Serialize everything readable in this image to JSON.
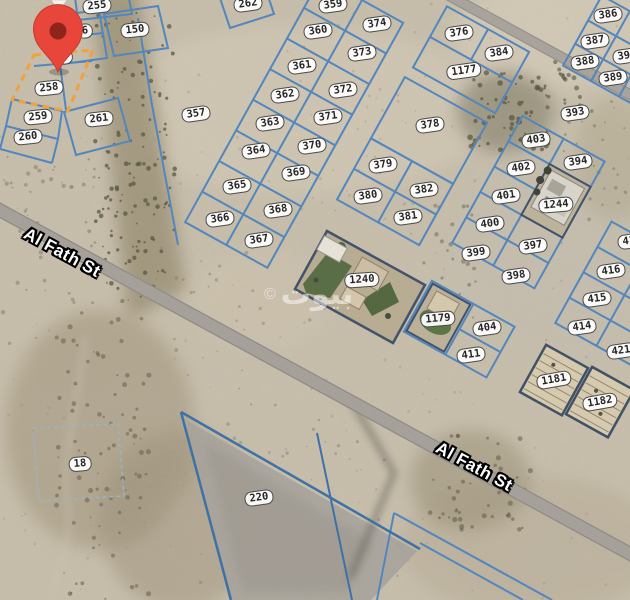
{
  "app": {
    "type": "satellite-parcel-map",
    "description": "Satellite map with land parcel boundaries and plot numbers"
  },
  "watermark": {
    "copyright": "©",
    "brand": "بيوت"
  },
  "streets": [
    {
      "name": "Al Fath St",
      "x": 62,
      "y": 253
    },
    {
      "name": "Al Fath St",
      "x": 474,
      "y": 467
    }
  ],
  "marker": {
    "name": "selected-location",
    "color": "#E8463A",
    "inner_color": "#8E251B"
  },
  "highlight": {
    "parcel": "258",
    "color": "#F2A13C"
  },
  "parcels": [
    {
      "num": "255",
      "x": 97,
      "y": 6,
      "rot": -6
    },
    {
      "num": "150",
      "x": 135,
      "y": 30,
      "rot": -6
    },
    {
      "num": "6",
      "x": 85,
      "y": 31,
      "rot": -6
    },
    {
      "num": "7",
      "x": 65,
      "y": 57,
      "rot": -6
    },
    {
      "num": "258",
      "x": 49,
      "y": 88,
      "rot": -6
    },
    {
      "num": "259",
      "x": 38,
      "y": 117,
      "rot": -6
    },
    {
      "num": "260",
      "x": 28,
      "y": 137,
      "rot": -6
    },
    {
      "num": "261",
      "x": 99,
      "y": 119,
      "rot": -6
    },
    {
      "num": "357",
      "x": 196,
      "y": 114,
      "rot": -8
    },
    {
      "num": "262",
      "x": 248,
      "y": 4,
      "rot": -8
    },
    {
      "num": "359",
      "x": 333,
      "y": 5,
      "rot": -8
    },
    {
      "num": "374",
      "x": 377,
      "y": 24,
      "rot": -8
    },
    {
      "num": "360",
      "x": 318,
      "y": 31,
      "rot": -8
    },
    {
      "num": "373",
      "x": 362,
      "y": 53,
      "rot": -8
    },
    {
      "num": "361",
      "x": 302,
      "y": 66,
      "rot": -8
    },
    {
      "num": "372",
      "x": 343,
      "y": 90,
      "rot": -8
    },
    {
      "num": "362",
      "x": 285,
      "y": 95,
      "rot": -8
    },
    {
      "num": "371",
      "x": 328,
      "y": 117,
      "rot": -8
    },
    {
      "num": "363",
      "x": 270,
      "y": 123,
      "rot": -8
    },
    {
      "num": "370",
      "x": 312,
      "y": 146,
      "rot": -8
    },
    {
      "num": "364",
      "x": 256,
      "y": 151,
      "rot": -8
    },
    {
      "num": "369",
      "x": 296,
      "y": 173,
      "rot": -8
    },
    {
      "num": "365",
      "x": 237,
      "y": 186,
      "rot": -8
    },
    {
      "num": "368",
      "x": 278,
      "y": 210,
      "rot": -8
    },
    {
      "num": "366",
      "x": 220,
      "y": 219,
      "rot": -8
    },
    {
      "num": "367",
      "x": 259,
      "y": 240,
      "rot": -8
    },
    {
      "num": "376",
      "x": 459,
      "y": 33,
      "rot": -8
    },
    {
      "num": "384",
      "x": 499,
      "y": 53,
      "rot": -8
    },
    {
      "num": "1177",
      "x": 464,
      "y": 71,
      "rot": -8
    },
    {
      "num": "386",
      "x": 608,
      "y": 15,
      "rot": -8
    },
    {
      "num": "387",
      "x": 595,
      "y": 41,
      "rot": -8
    },
    {
      "num": "390",
      "x": 627,
      "y": 56,
      "rot": -8
    },
    {
      "num": "388",
      "x": 585,
      "y": 62,
      "rot": -8
    },
    {
      "num": "389",
      "x": 613,
      "y": 78,
      "rot": -8
    },
    {
      "num": "393",
      "x": 575,
      "y": 113,
      "rot": -8
    },
    {
      "num": "378",
      "x": 430,
      "y": 125,
      "rot": -8
    },
    {
      "num": "403",
      "x": 536,
      "y": 140,
      "rot": -8
    },
    {
      "num": "394",
      "x": 578,
      "y": 162,
      "rot": -8
    },
    {
      "num": "379",
      "x": 383,
      "y": 165,
      "rot": -8
    },
    {
      "num": "402",
      "x": 521,
      "y": 168,
      "rot": -8
    },
    {
      "num": "382",
      "x": 424,
      "y": 190,
      "rot": -8
    },
    {
      "num": "380",
      "x": 368,
      "y": 196,
      "rot": -8
    },
    {
      "num": "401",
      "x": 506,
      "y": 196,
      "rot": -8
    },
    {
      "num": "1244",
      "x": 556,
      "y": 205,
      "rot": -5
    },
    {
      "num": "381",
      "x": 408,
      "y": 217,
      "rot": -8
    },
    {
      "num": "400",
      "x": 490,
      "y": 224,
      "rot": -8
    },
    {
      "num": "417",
      "x": 632,
      "y": 241,
      "rot": -8
    },
    {
      "num": "397",
      "x": 533,
      "y": 246,
      "rot": -8
    },
    {
      "num": "399",
      "x": 476,
      "y": 253,
      "rot": -8
    },
    {
      "num": "416",
      "x": 611,
      "y": 271,
      "rot": -8
    },
    {
      "num": "398",
      "x": 516,
      "y": 276,
      "rot": -8
    },
    {
      "num": "1240",
      "x": 362,
      "y": 280,
      "rot": -4
    },
    {
      "num": "415",
      "x": 597,
      "y": 299,
      "rot": -8
    },
    {
      "num": "1179",
      "x": 438,
      "y": 319,
      "rot": -5
    },
    {
      "num": "414",
      "x": 582,
      "y": 327,
      "rot": -8
    },
    {
      "num": "404",
      "x": 487,
      "y": 328,
      "rot": -8
    },
    {
      "num": "421",
      "x": 621,
      "y": 351,
      "rot": -8
    },
    {
      "num": "411",
      "x": 471,
      "y": 355,
      "rot": -8
    },
    {
      "num": "1181",
      "x": 554,
      "y": 380,
      "rot": -10
    },
    {
      "num": "1182",
      "x": 600,
      "y": 402,
      "rot": -10
    },
    {
      "num": "18",
      "x": 80,
      "y": 464,
      "rot": -5
    },
    {
      "num": "220",
      "x": 259,
      "y": 498,
      "rot": -8
    }
  ],
  "colors": {
    "parcel_line": "#4f86c0",
    "boundary_dark": "#3a70a8",
    "road": "#a6a29b",
    "terrain": "#c8bfad",
    "compound_wall": "#3e5069",
    "label_bg": "#ffffff",
    "label_text": "#252525",
    "highlight": "#F2A13C",
    "pin": "#E8463A"
  }
}
